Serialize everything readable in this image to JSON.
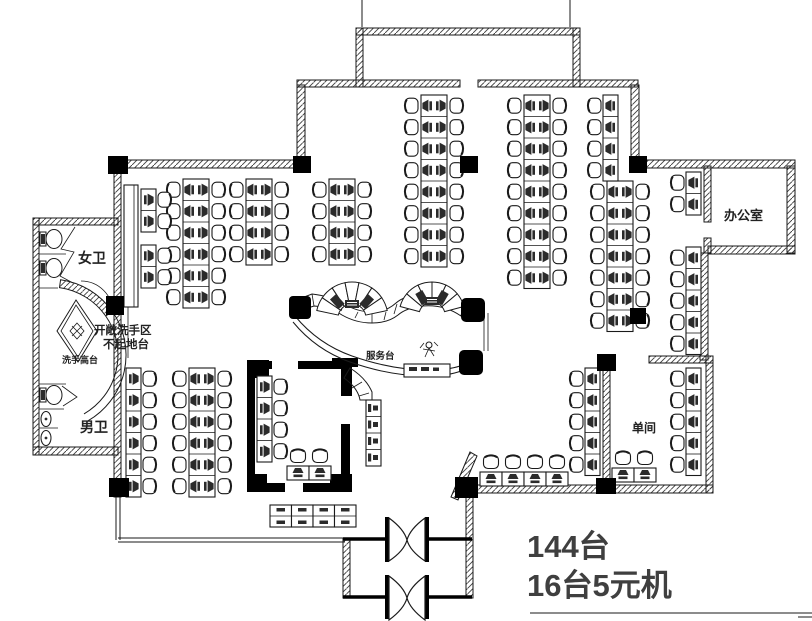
{
  "drawing": {
    "type": "internet-cafe-floor-plan",
    "annotations": {
      "total": "144台",
      "five_yuan": "16台5元机"
    },
    "rooms": {
      "women_wc": "女卫",
      "men_wc": "男卫",
      "office": "办公室",
      "private_room": "单间",
      "service_desk": "服务台",
      "wash_area_line1": "开敞洗手区",
      "wash_area_line2": "不起地台",
      "wash_counter": "洗手高台"
    },
    "colors": {
      "ink": "#1a1a1a",
      "solid_wall": "#000000",
      "annotation_text": "#3f3f3f"
    },
    "stations": {
      "unit": {
        "row_h": 21.5,
        "double_w": 26,
        "single_w": 15
      },
      "double_cols": [
        {
          "x": 183,
          "y": 179,
          "n": 6
        },
        {
          "x": 246,
          "y": 179,
          "n": 4
        },
        {
          "x": 329,
          "y": 179,
          "n": 4
        },
        {
          "x": 421,
          "y": 95,
          "n": 8
        },
        {
          "x": 524,
          "y": 95,
          "n": 9
        },
        {
          "x": 607,
          "y": 181,
          "n": 7
        },
        {
          "x": 189,
          "y": 368,
          "n": 6
        }
      ],
      "single_cols": [
        {
          "x": 141,
          "y": 189,
          "n": 2,
          "chair": "right"
        },
        {
          "x": 141,
          "y": 245,
          "n": 2,
          "chair": "right"
        },
        {
          "x": 603,
          "y": 95,
          "n": 4,
          "chair": "left"
        },
        {
          "x": 686,
          "y": 172,
          "n": 2,
          "chair": "left"
        },
        {
          "x": 686,
          "y": 247,
          "n": 5,
          "chair": "left"
        },
        {
          "x": 686,
          "y": 368,
          "n": 5,
          "chair": "left"
        },
        {
          "x": 126,
          "y": 368,
          "n": 6,
          "chair": "right"
        },
        {
          "x": 257,
          "y": 376,
          "n": 4,
          "chair": "right"
        },
        {
          "x": 585,
          "y": 368,
          "n": 5,
          "chair": "left"
        }
      ],
      "h_rows": [
        {
          "x": 480,
          "y": 472,
          "n": 4
        },
        {
          "x": 612,
          "y": 468,
          "n": 2
        },
        {
          "x": 287,
          "y": 466,
          "n": 2
        }
      ],
      "desk_blocks": [
        {
          "x": 270,
          "y": 505,
          "n": 4,
          "w": 21.5,
          "h": 22,
          "orient": "h-double"
        },
        {
          "x": 366,
          "y": 400,
          "n": 4,
          "w": 15,
          "h": 16.5,
          "orient": "v-strip"
        }
      ],
      "fans": [
        {
          "cx": 352,
          "cy": 318,
          "r0": 14,
          "r1": 36,
          "a0": -168,
          "a1": -12,
          "n": 7,
          "monitors": [
            -132,
            -48
          ],
          "mr": 22
        },
        {
          "cx": 432,
          "cy": 315,
          "r0": 13,
          "r1": 33,
          "a0": -165,
          "a1": -15,
          "n": 6,
          "monitors": [
            -120,
            -60
          ],
          "mr": 20
        }
      ]
    }
  }
}
